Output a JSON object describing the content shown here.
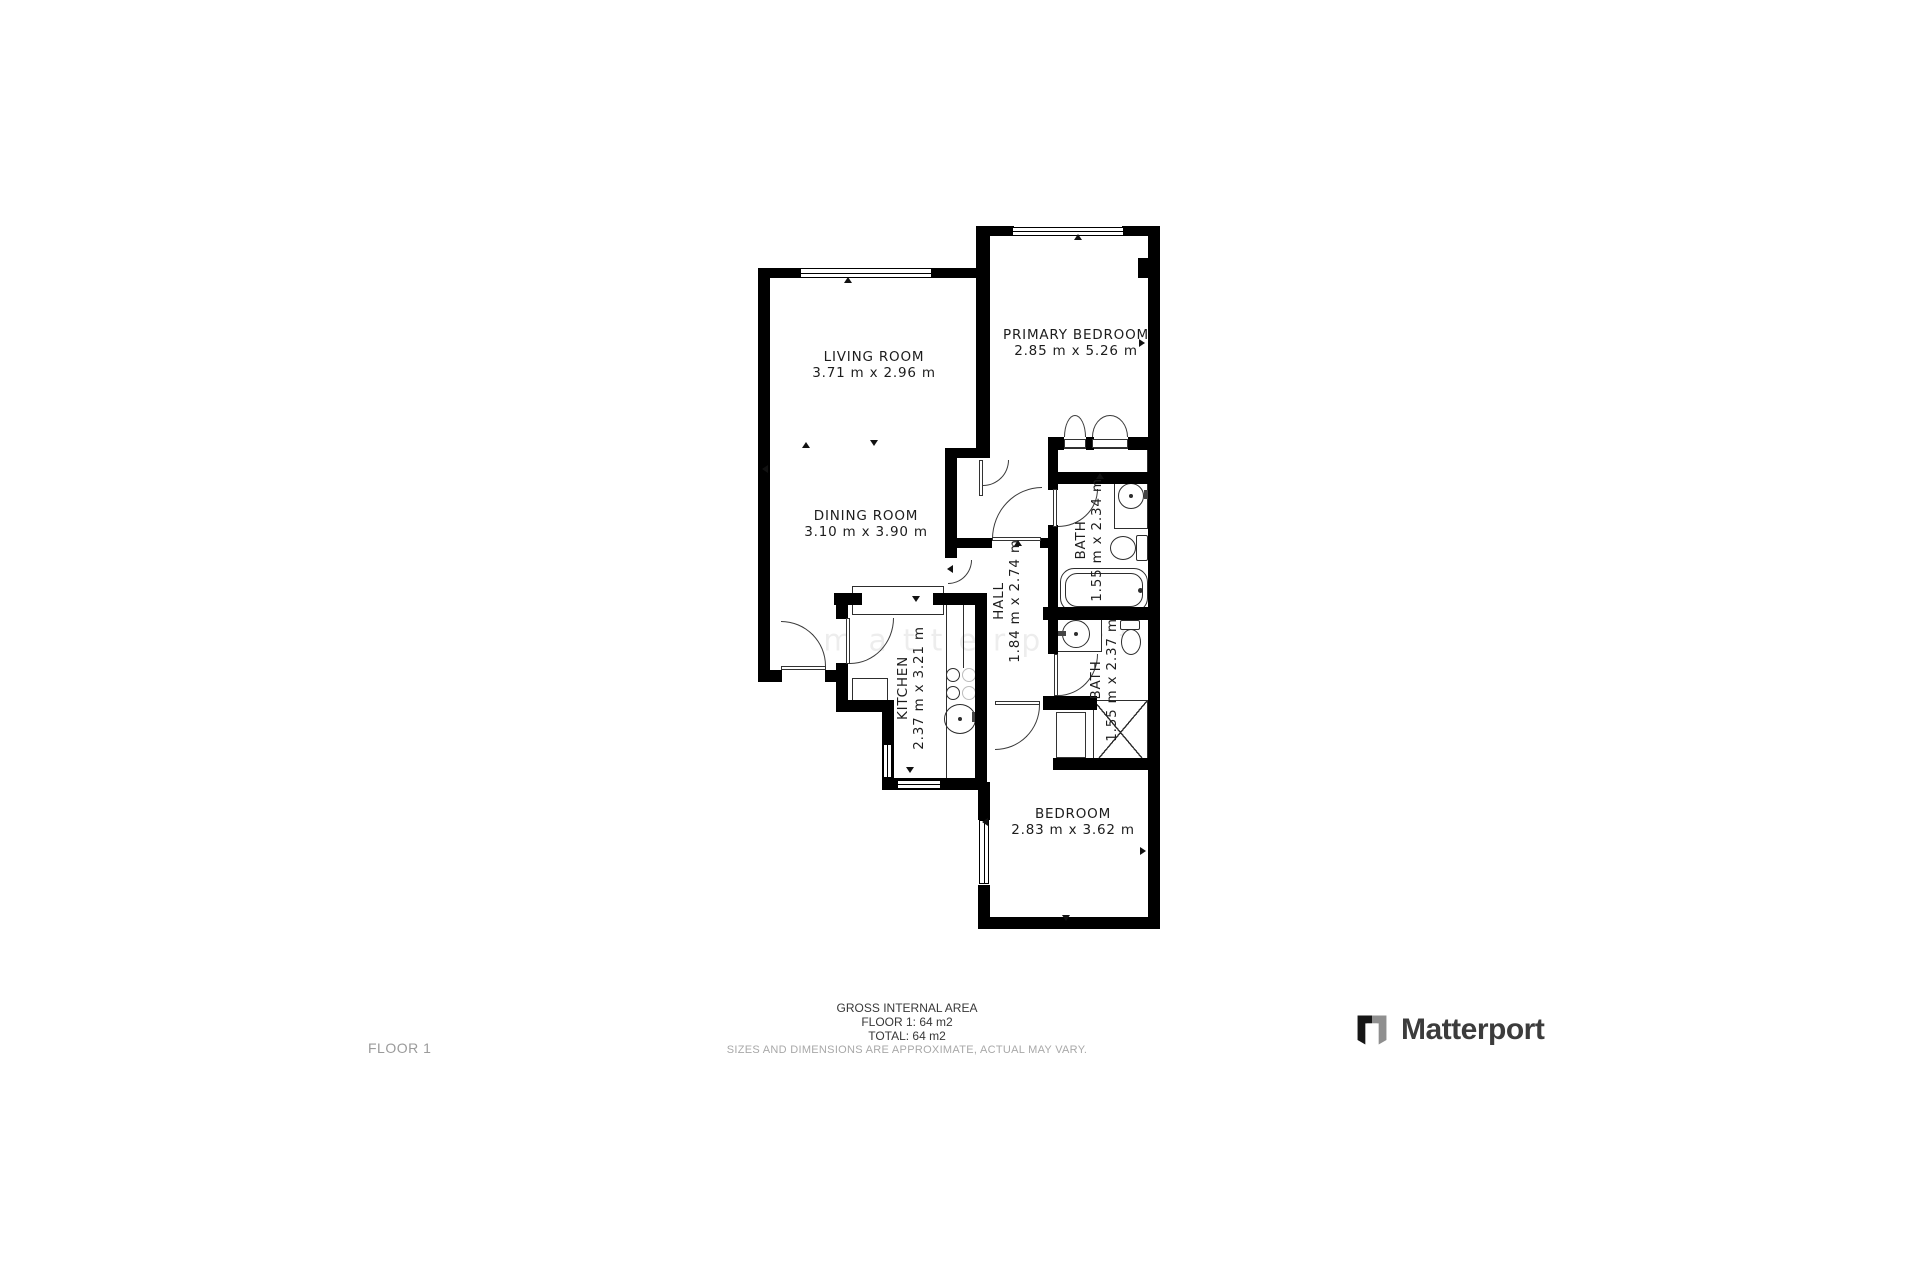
{
  "floorplan": {
    "rooms": [
      {
        "id": "living-room",
        "name": "LIVING ROOM",
        "dims": "3.71 m x 2.96 m"
      },
      {
        "id": "dining-room",
        "name": "DINING ROOM",
        "dims": "3.10 m x 3.90 m"
      },
      {
        "id": "primary-bedroom",
        "name": "PRIMARY BEDROOM",
        "dims": "2.85 m x 5.26 m"
      },
      {
        "id": "kitchen",
        "name": "KITCHEN",
        "dims": "2.37 m x 3.21 m"
      },
      {
        "id": "hall",
        "name": "HALL",
        "dims": "1.84 m x 2.74 m"
      },
      {
        "id": "bath-1",
        "name": "BATH",
        "dims": "1.55 m x 2.34 m"
      },
      {
        "id": "bath-2",
        "name": "BATH",
        "dims": "1.55 m x 2.37 m"
      },
      {
        "id": "bedroom",
        "name": "BEDROOM",
        "dims": "2.83 m x 3.62 m"
      }
    ],
    "watermark": "matterport"
  },
  "footer": {
    "floor_label": "FLOOR 1",
    "area_title": "GROSS INTERNAL AREA",
    "area_floor": "FLOOR 1: 64 m2",
    "area_total": "TOTAL: 64 m2",
    "disclaimer": "SIZES AND DIMENSIONS ARE APPROXIMATE, ACTUAL MAY VARY.",
    "brand": "Matterport"
  },
  "colors": {
    "walls": "#000000",
    "label_text": "#1d1d1d",
    "muted_text": "#a8a8a8",
    "brand_text": "#3c3c3c",
    "brand_icon_gray": "#8f8f8f"
  }
}
